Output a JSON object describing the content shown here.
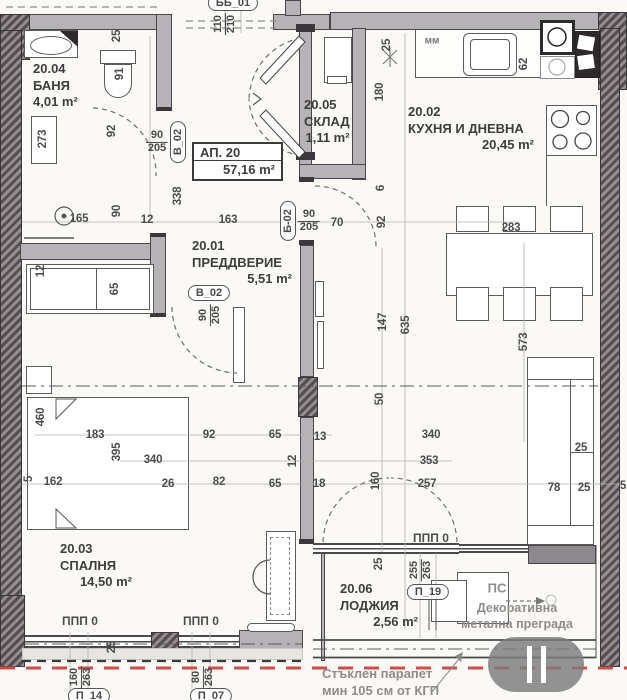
{
  "apartment": {
    "label": "АП. 20",
    "area": "57,16 m²"
  },
  "rooms": [
    {
      "id": "20.04",
      "name": "БАНЯ",
      "area": "4,01 m²"
    },
    {
      "id": "20.05",
      "name": "СКЛАД",
      "area": "1,11 m²"
    },
    {
      "id": "20.02",
      "name": "КУХНЯ И ДНЕВНА",
      "area": "20,45 m²"
    },
    {
      "id": "20.01",
      "name": "ПРЕДДВЕРИЕ",
      "area": "5,51 m²"
    },
    {
      "id": "20.03",
      "name": "СПАЛНЯ",
      "area": "14,50 m²"
    },
    {
      "id": "20.06",
      "name": "ЛОДЖИЯ",
      "area": "2,56 m²"
    }
  ],
  "openings": [
    {
      "tag": "ББ_01",
      "w": "110",
      "h": "210"
    },
    {
      "tag": "В_02",
      "w": "90",
      "h": "205"
    },
    {
      "tag": "Б-02",
      "w": "90",
      "h": "205"
    },
    {
      "tag": "В_02",
      "w": "90",
      "h": "205"
    },
    {
      "tag": "П_19",
      "w": "255",
      "h": "263"
    },
    {
      "tag": "П_14",
      "w": "160",
      "h": "263"
    },
    {
      "tag": "П_07",
      "w": "80",
      "h": "263"
    }
  ],
  "annotations": {
    "ppp": "ППП 0",
    "mm": "мм",
    "ps": "ПС",
    "deco_line1": "Декоративна",
    "deco_line2": "метална преграда",
    "parapet_line1": "Стъклен парапет",
    "parapet_line2": "мин 105 см от КГП"
  },
  "dimensions": [
    {
      "t": "25",
      "x": 117,
      "y": 36,
      "v": 1
    },
    {
      "t": "91",
      "x": 120,
      "y": 74,
      "v": 1
    },
    {
      "t": "273",
      "x": 43,
      "y": 139,
      "v": 1
    },
    {
      "t": "92",
      "x": 112,
      "y": 131,
      "v": 1
    },
    {
      "t": "338",
      "x": 178,
      "y": 196,
      "v": 1
    },
    {
      "t": "90",
      "x": 117,
      "y": 211,
      "v": 1
    },
    {
      "t": "165",
      "x": 79,
      "y": 219,
      "v": 0
    },
    {
      "t": "12",
      "x": 147,
      "y": 220,
      "v": 0
    },
    {
      "t": "163",
      "x": 228,
      "y": 220,
      "v": 0
    },
    {
      "t": "70",
      "x": 337,
      "y": 223,
      "v": 0
    },
    {
      "t": "92",
      "x": 382,
      "y": 222,
      "v": 1
    },
    {
      "t": "6",
      "x": 381,
      "y": 188,
      "v": 1
    },
    {
      "t": "180",
      "x": 380,
      "y": 92,
      "v": 1
    },
    {
      "t": "25",
      "x": 387,
      "y": 45,
      "v": 1
    },
    {
      "t": "62",
      "x": 524,
      "y": 64,
      "v": 1
    },
    {
      "t": "283",
      "x": 511,
      "y": 228,
      "v": 0
    },
    {
      "t": "147",
      "x": 383,
      "y": 322,
      "v": 1
    },
    {
      "t": "635",
      "x": 406,
      "y": 325,
      "v": 1
    },
    {
      "t": "573",
      "x": 524,
      "y": 342,
      "v": 1
    },
    {
      "t": "50",
      "x": 380,
      "y": 399,
      "v": 1
    },
    {
      "t": "12",
      "x": 41,
      "y": 271,
      "v": 1
    },
    {
      "t": "65",
      "x": 115,
      "y": 289,
      "v": 1
    },
    {
      "t": "460",
      "x": 41,
      "y": 417,
      "v": 1
    },
    {
      "t": "183",
      "x": 95,
      "y": 435,
      "v": 0
    },
    {
      "t": "395",
      "x": 117,
      "y": 452,
      "v": 1
    },
    {
      "t": "340",
      "x": 153,
      "y": 460,
      "v": 0
    },
    {
      "t": "92",
      "x": 209,
      "y": 435,
      "v": 0
    },
    {
      "t": "65",
      "x": 275,
      "y": 435,
      "v": 0
    },
    {
      "t": "13",
      "x": 320,
      "y": 437,
      "v": 0
    },
    {
      "t": "12",
      "x": 293,
      "y": 461,
      "v": 1
    },
    {
      "t": "340",
      "x": 431,
      "y": 435,
      "v": 0
    },
    {
      "t": "353",
      "x": 429,
      "y": 461,
      "v": 0
    },
    {
      "t": "25",
      "x": 581,
      "y": 448,
      "v": 0
    },
    {
      "t": "162",
      "x": 53,
      "y": 482,
      "v": 0
    },
    {
      "t": "26",
      "x": 168,
      "y": 484,
      "v": 0
    },
    {
      "t": "82",
      "x": 219,
      "y": 482,
      "v": 0
    },
    {
      "t": "65",
      "x": 275,
      "y": 484,
      "v": 0
    },
    {
      "t": "5",
      "x": 29,
      "y": 479,
      "v": 1
    },
    {
      "t": "18",
      "x": 319,
      "y": 484,
      "v": 0
    },
    {
      "t": "160",
      "x": 376,
      "y": 481,
      "v": 1
    },
    {
      "t": "257",
      "x": 427,
      "y": 484,
      "v": 0
    },
    {
      "t": "78",
      "x": 554,
      "y": 488,
      "v": 0
    },
    {
      "t": "25",
      "x": 584,
      "y": 488,
      "v": 0
    },
    {
      "t": "5",
      "x": 623,
      "y": 486,
      "v": 0
    },
    {
      "t": "25",
      "x": 112,
      "y": 647,
      "v": 1
    },
    {
      "t": "25",
      "x": 379,
      "y": 564,
      "v": 1
    }
  ],
  "colors": {
    "wall": "#b6b3b6",
    "wall_dark": "#5e5659",
    "line": "#4a4a4a",
    "red_boundary": "#c94f4c",
    "text_gray": "#8e8c8a"
  }
}
